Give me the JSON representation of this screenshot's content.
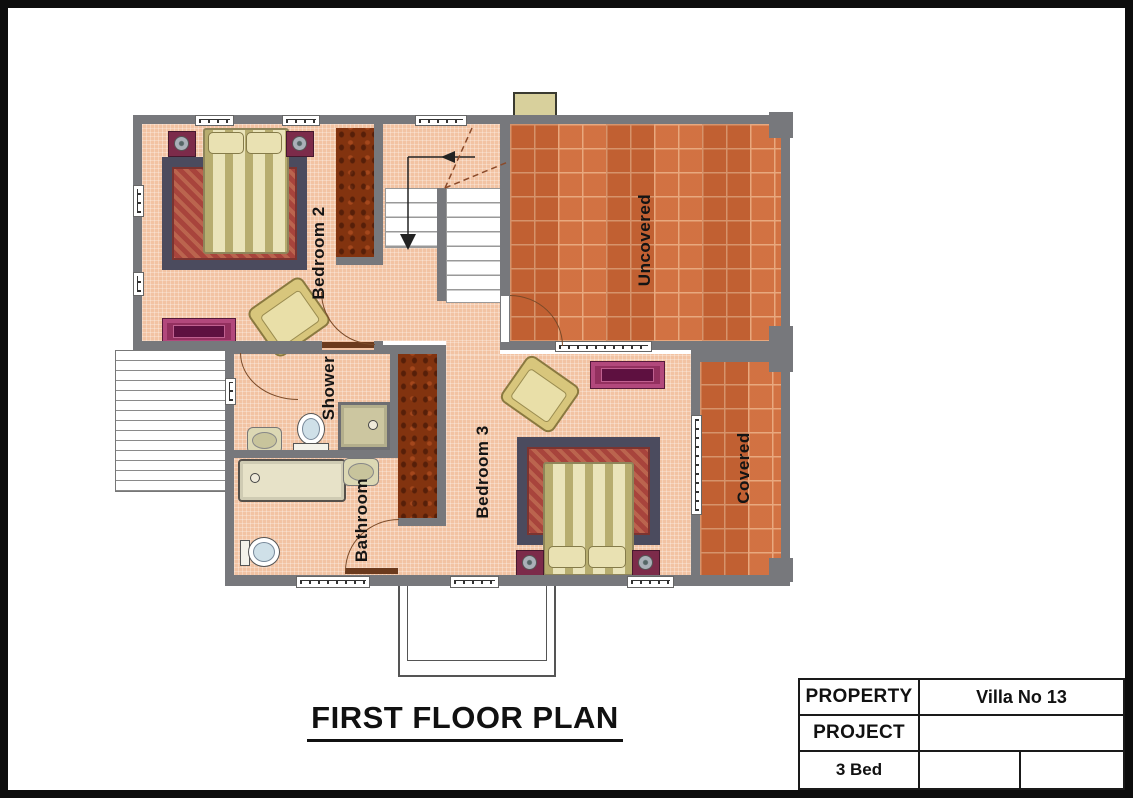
{
  "plan": {
    "title": "FIRST FLOOR PLAN",
    "rooms": {
      "bedroom2": "Bedroom 2",
      "shower": "Shower",
      "bathroom": "Bathroom",
      "bedroom3": "Bedroom 3",
      "uncovered": "Uncovered",
      "covered": "Covered"
    }
  },
  "title_block": {
    "property_label": "PROPERTY",
    "property_value": "Villa No 13",
    "project_label": "PROJECT",
    "project_value": "",
    "beds_label": "3 Bed",
    "beds_value_1": "",
    "beds_value_2": ""
  },
  "colors": {
    "wall": "#77787c",
    "floor": "#f2c3a3",
    "terrace_tile": "#cd6838",
    "tile_grout": "#e5a47a",
    "wardrobe": "#82330f",
    "furniture_gold": "#d8c67c",
    "furniture_purple": "#93305f",
    "rug_border": "#4b4b5e",
    "rug_field": "#a8443c",
    "fixture_beige": "#dcd8b4",
    "door_arc": "#7a4a28",
    "frame": "#0d0d0d"
  }
}
